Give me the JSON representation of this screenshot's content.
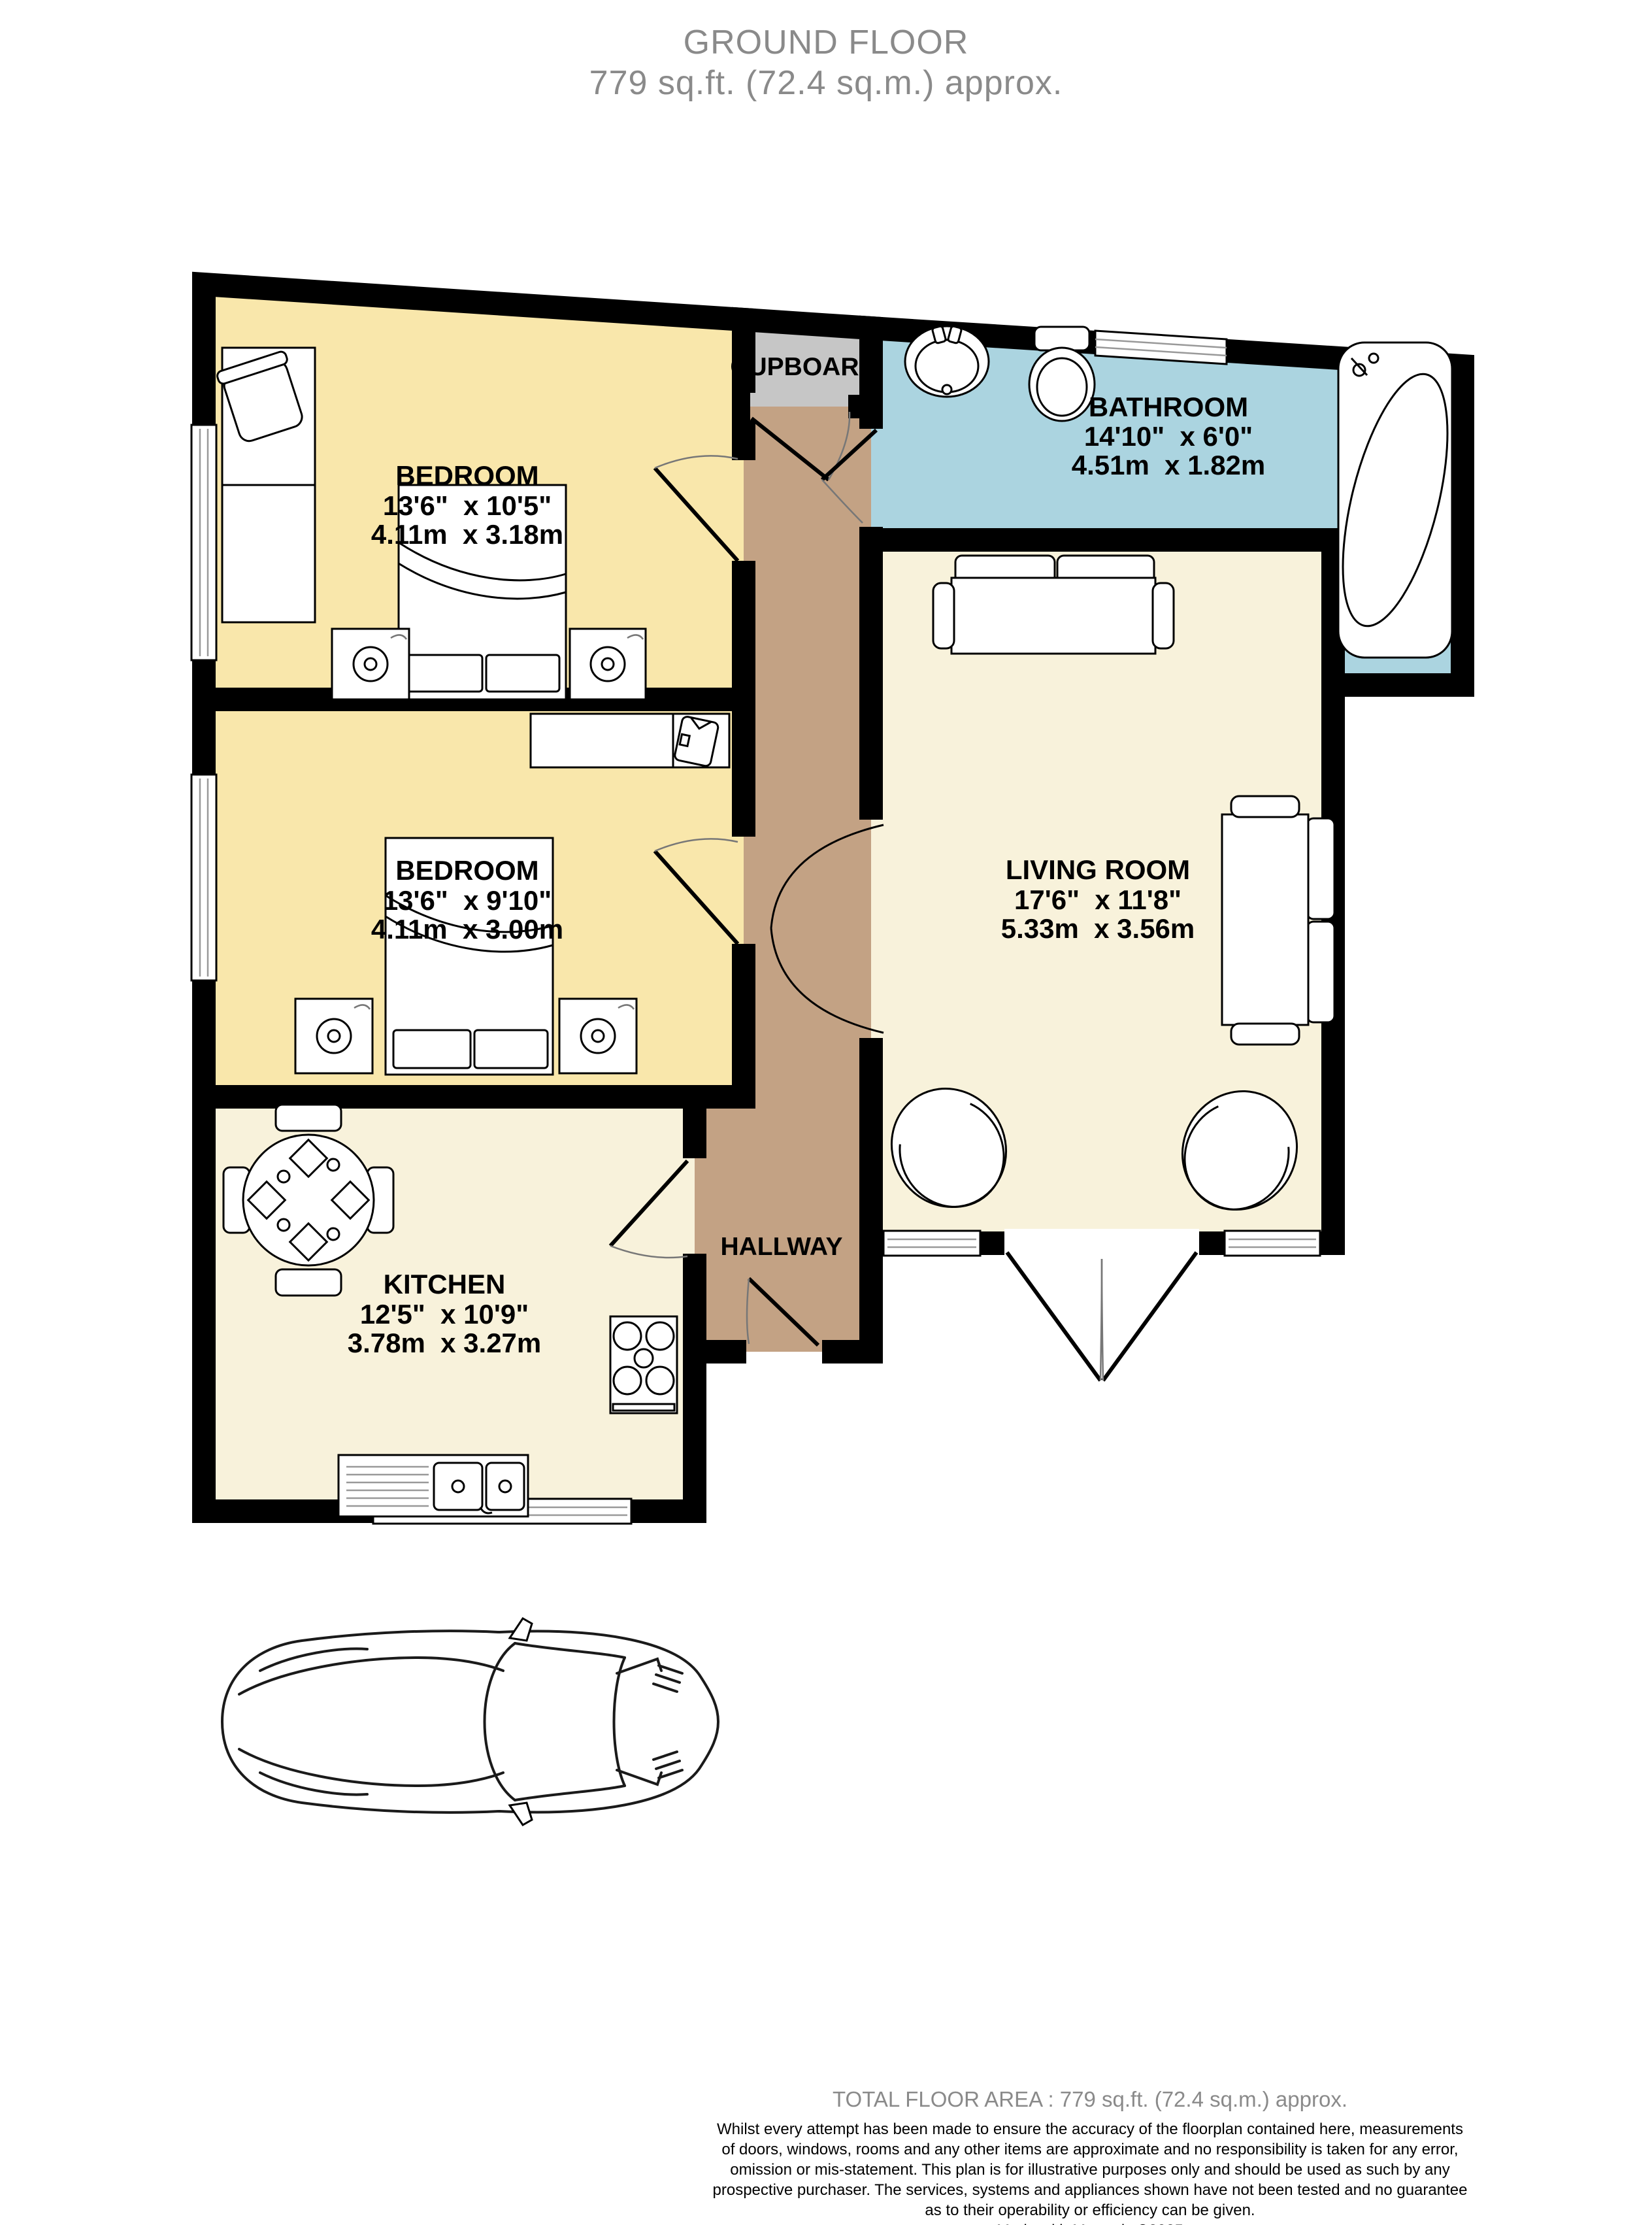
{
  "title": {
    "line1": "GROUND FLOOR",
    "line2": "779 sq.ft. (72.4 sq.m.) approx."
  },
  "rooms": {
    "bedroom1": {
      "name": "BEDROOM",
      "imperial": "13'6\"  x 10'5\"",
      "metric": "4.11m  x 3.18m"
    },
    "bedroom2": {
      "name": "BEDROOM",
      "imperial": "13'6\"  x 9'10\"",
      "metric": "4.11m  x 3.00m"
    },
    "bathroom": {
      "name": "BATHROOM",
      "imperial": "14'10\"  x 6'0\"",
      "metric": "4.51m  x 1.82m"
    },
    "living_room": {
      "name": "LIVING ROOM",
      "imperial": "17'6\"  x 11'8\"",
      "metric": "5.33m  x 3.56m"
    },
    "kitchen": {
      "name": "KITCHEN",
      "imperial": "12'5\"  x 10'9\"",
      "metric": "3.78m  x 3.27m"
    },
    "hallway": {
      "name": "HALLWAY"
    },
    "cupboard": {
      "name": "CUPBOARD"
    }
  },
  "footer": {
    "total": "TOTAL FLOOR AREA : 779 sq.ft. (72.4 sq.m.) approx.",
    "disclaimer_lines": [
      "Whilst every attempt has been made to ensure the accuracy of the floorplan contained here, measurements",
      "of doors, windows, rooms and any other items are approximate and no responsibility is taken for any error,",
      "omission or mis-statement. This plan is for illustrative purposes only and should be used as such by any",
      "prospective purchaser. The services, systems and appliances shown have not been tested and no guarantee",
      "as to their operability or efficiency can be given."
    ],
    "credit": "Made with Metropix ©2025"
  },
  "colors": {
    "wall": "#000000",
    "bedroom": "#F9E7AB",
    "kitchen_living": "#F8F2DB",
    "bathroom": "#ABD4E0",
    "hallway": "#C3A284",
    "cupboard": "#C6C6C6",
    "text_muted": "#8A8A8A"
  },
  "icons": [
    "double-bed-icon",
    "speaker-icon",
    "desk-icon",
    "desk-chair-icon",
    "wardrobe-shirt-icon",
    "dining-table-icon",
    "dining-chair-icon",
    "hob-icon",
    "kitchen-sink-icon",
    "sofa-icon",
    "armchair-icon",
    "washbasin-icon",
    "toilet-icon",
    "corner-bath-icon",
    "window-icon",
    "door-swing-icon",
    "car-icon"
  ]
}
